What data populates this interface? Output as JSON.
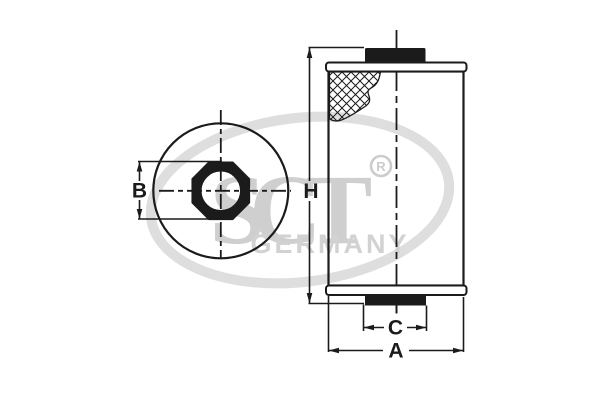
{
  "diagram": {
    "dimensions": {
      "b": "B",
      "h": "H",
      "c": "C",
      "a": "A"
    },
    "watermark": {
      "brand": "SCT",
      "registered_letter": "R",
      "country": "GERMANY"
    },
    "colors": {
      "line": "#1b1b1b",
      "watermark_light": "#dedede",
      "watermark_text": "#cfcfcf",
      "background": "#ffffff"
    }
  }
}
